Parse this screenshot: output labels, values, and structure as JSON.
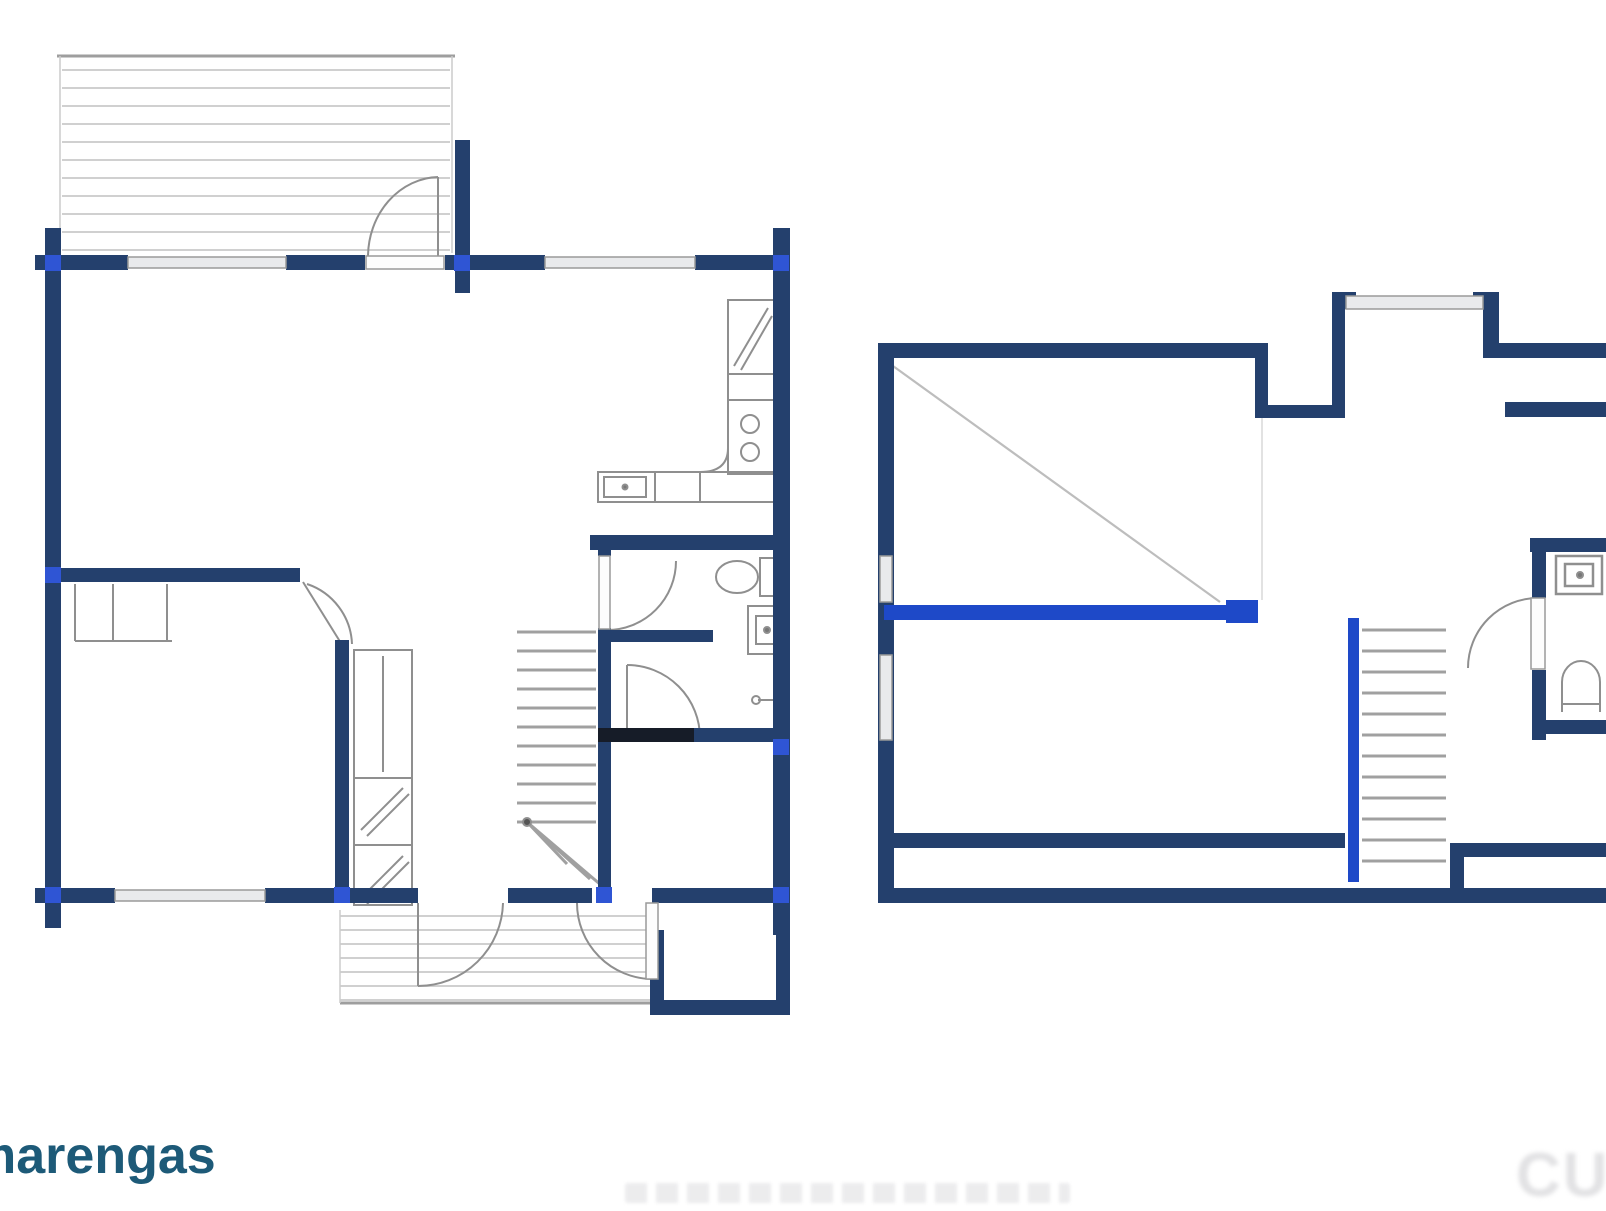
{
  "branding": {
    "logo_text": "marengas"
  },
  "watermark": {
    "bottom_right": "CUE"
  },
  "palette": {
    "wall": "#24406d",
    "wall_dark": "#161c28",
    "accent_dot": "#2f55d4",
    "bright_blue": "#1e49c8",
    "window_fill": "#e9eaec",
    "window_stroke": "#9a9a9a",
    "leaf_fill": "#fdfdfd",
    "fixture": "#8f8f8f",
    "tread": "#a0a0a0",
    "deck_line": "#d0d0d0",
    "deck_edge": "#9e9e9e",
    "slope": "#bdbdbd"
  },
  "left": {
    "deck_lines": [
      [
        62,
        70,
        450,
        70
      ],
      [
        62,
        88,
        450,
        88
      ],
      [
        62,
        106,
        450,
        106
      ],
      [
        62,
        124,
        450,
        124
      ],
      [
        62,
        142,
        450,
        142
      ],
      [
        62,
        160,
        450,
        160
      ],
      [
        62,
        178,
        450,
        178
      ],
      [
        62,
        196,
        450,
        196
      ],
      [
        62,
        214,
        450,
        214
      ],
      [
        62,
        232,
        450,
        232
      ],
      [
        62,
        250,
        450,
        250
      ],
      [
        340,
        916,
        652,
        916
      ],
      [
        340,
        930,
        652,
        930
      ],
      [
        340,
        944,
        652,
        944
      ],
      [
        340,
        958,
        652,
        958
      ],
      [
        340,
        972,
        652,
        972
      ],
      [
        340,
        986,
        652,
        986
      ],
      [
        340,
        1000,
        652,
        1000
      ]
    ],
    "deck_edges": [
      [
        57,
        56,
        455,
        56
      ],
      [
        340,
        1003,
        660,
        1003
      ]
    ],
    "deck_sides": [
      [
        60,
        56,
        60,
        253
      ],
      [
        452,
        56,
        452,
        253
      ],
      [
        340,
        910,
        340,
        1003
      ]
    ],
    "stair_treads": [
      [
        517,
        632,
        596,
        632
      ],
      [
        517,
        651,
        596,
        651
      ],
      [
        517,
        670,
        596,
        670
      ],
      [
        517,
        689,
        596,
        689
      ],
      [
        517,
        708,
        596,
        708
      ],
      [
        517,
        727,
        596,
        727
      ],
      [
        517,
        746,
        596,
        746
      ],
      [
        517,
        765,
        596,
        765
      ],
      [
        517,
        784,
        596,
        784
      ],
      [
        517,
        803,
        596,
        803
      ],
      [
        517,
        822,
        596,
        822
      ]
    ],
    "stair_fan": [
      [
        527,
        822,
        567,
        864
      ],
      [
        527,
        822,
        590,
        879
      ],
      [
        527,
        822,
        608,
        891
      ]
    ],
    "fixture_lines": [
      [
        113,
        584,
        113,
        641
      ],
      [
        167,
        584,
        167,
        641
      ],
      [
        75,
        584,
        75,
        641
      ],
      [
        75,
        641,
        172,
        641
      ],
      [
        354,
        778,
        412,
        778
      ],
      [
        354,
        845,
        412,
        845
      ],
      [
        383,
        656,
        383,
        772
      ],
      [
        361,
        830,
        403,
        788
      ],
      [
        367,
        836,
        409,
        794
      ],
      [
        361,
        898,
        403,
        856
      ],
      [
        367,
        904,
        409,
        862
      ],
      [
        734,
        366,
        768,
        308
      ],
      [
        741,
        370,
        772,
        316
      ],
      [
        655,
        472,
        655,
        502
      ],
      [
        700,
        472,
        700,
        502
      ],
      [
        728,
        400,
        774,
        400
      ],
      [
        438,
        177,
        438,
        257
      ],
      [
        418,
        903,
        418,
        986
      ],
      [
        627,
        665,
        627,
        737
      ],
      [
        303,
        582,
        344,
        648
      ],
      [
        758,
        700,
        776,
        700
      ]
    ],
    "fixture_rects": [
      [
        354,
        650,
        58,
        255
      ],
      [
        728,
        300,
        46,
        74
      ],
      [
        728,
        374,
        46,
        100
      ],
      [
        598,
        472,
        176,
        30
      ],
      [
        604,
        477,
        42,
        20
      ],
      [
        760,
        558,
        28,
        38
      ],
      [
        748,
        606,
        40,
        48
      ],
      [
        756,
        616,
        24,
        28
      ],
      [
        776,
        692,
        12,
        10
      ]
    ],
    "fixture_extras": [
      {
        "tag": "path",
        "d": "M 368 257 A 72 80 0 0 1 438 177"
      },
      {
        "tag": "path",
        "d": "M 418 986 A 85 85 0 0 0 503 903"
      },
      {
        "tag": "path",
        "d": "M 577 903 A 76 76 0 0 0 652 979"
      },
      {
        "tag": "path",
        "d": "M 307 584 A 66 66 0 0 1 352 644"
      },
      {
        "tag": "path",
        "d": "M 676 561 A 69 69 0 0 1 607 630"
      },
      {
        "tag": "path",
        "d": "M 627 665 A 73 73 0 0 1 700 738"
      },
      {
        "tag": "path",
        "d": "M 700 472 Q 728 472 728 448"
      },
      {
        "tag": "ellipse",
        "cx": 737,
        "cy": 577,
        "rx": 21,
        "ry": 16
      },
      {
        "tag": "circle",
        "cx": 750,
        "cy": 424,
        "r": 9
      },
      {
        "tag": "circle",
        "cx": 750,
        "cy": 452,
        "r": 9
      },
      {
        "tag": "circle",
        "cx": 625,
        "cy": 487,
        "r": 2.5,
        "fill": "#777777"
      },
      {
        "tag": "circle",
        "cx": 767,
        "cy": 630,
        "r": 3,
        "fill": "#777777"
      },
      {
        "tag": "circle",
        "cx": 756,
        "cy": 700,
        "r": 4
      },
      {
        "tag": "circle",
        "cx": 527,
        "cy": 822,
        "r": 4,
        "fill": "#555555"
      }
    ],
    "walls": [
      [
        35,
        255,
        93,
        15
      ],
      [
        286,
        255,
        79,
        15
      ],
      [
        445,
        255,
        100,
        15
      ],
      [
        695,
        255,
        95,
        15
      ],
      [
        45,
        228,
        16,
        700
      ],
      [
        455,
        140,
        15,
        153
      ],
      [
        773,
        228,
        17,
        512
      ],
      [
        773,
        740,
        17,
        195
      ],
      [
        650,
        930,
        14,
        85
      ],
      [
        650,
        1000,
        140,
        15
      ],
      [
        776,
        930,
        14,
        85
      ],
      [
        35,
        888,
        80,
        15
      ],
      [
        265,
        888,
        80,
        15
      ],
      [
        345,
        888,
        73,
        15
      ],
      [
        508,
        888,
        84,
        15
      ],
      [
        652,
        888,
        138,
        15
      ],
      [
        45,
        568,
        255,
        14
      ],
      [
        335,
        640,
        14,
        262
      ],
      [
        598,
        628,
        13,
        274
      ],
      [
        590,
        535,
        200,
        15
      ],
      [
        611,
        630,
        102,
        12
      ],
      [
        598,
        728,
        192,
        14
      ],
      [
        598,
        535,
        13,
        21
      ]
    ],
    "wall_dark": [
      [
        598,
        728,
        96,
        14
      ]
    ],
    "windows": [
      [
        128,
        257,
        158,
        11
      ],
      [
        545,
        257,
        150,
        11
      ],
      [
        115,
        890,
        150,
        11
      ]
    ],
    "door_leaves": [
      [
        366,
        256,
        78,
        13
      ],
      [
        599,
        556,
        11,
        73
      ],
      [
        646,
        903,
        12,
        76
      ]
    ],
    "dots": [
      [
        45,
        255,
        16,
        16
      ],
      [
        454,
        255,
        16,
        16
      ],
      [
        773,
        255,
        16,
        16
      ],
      [
        45,
        567,
        16,
        16
      ],
      [
        45,
        887,
        16,
        16
      ],
      [
        334,
        887,
        16,
        16
      ],
      [
        596,
        887,
        16,
        16
      ],
      [
        773,
        739,
        16,
        16
      ],
      [
        773,
        887,
        16,
        16
      ]
    ]
  },
  "right": {
    "slope_lines": [
      [
        893,
        366,
        1220,
        602
      ]
    ],
    "faint_lines": [
      [
        1262,
        418,
        1262,
        600
      ]
    ],
    "stair_treads": [
      [
        1362,
        630,
        1446,
        630
      ],
      [
        1362,
        651,
        1446,
        651
      ],
      [
        1362,
        672,
        1446,
        672
      ],
      [
        1362,
        693,
        1446,
        693
      ],
      [
        1362,
        714,
        1446,
        714
      ],
      [
        1362,
        735,
        1446,
        735
      ],
      [
        1362,
        756,
        1446,
        756
      ],
      [
        1362,
        777,
        1446,
        777
      ],
      [
        1362,
        798,
        1446,
        798
      ],
      [
        1362,
        819,
        1446,
        819
      ],
      [
        1362,
        840,
        1446,
        840
      ],
      [
        1362,
        861,
        1446,
        861
      ]
    ],
    "fixture_lines": [
      [
        1562,
        704,
        1600,
        704
      ]
    ],
    "fixture_rects": [
      [
        1556,
        556,
        46,
        38
      ],
      [
        1565,
        564,
        28,
        22
      ]
    ],
    "fixture_extras": [
      {
        "tag": "path",
        "d": "M 1468 668 A 70 70 0 0 1 1538 598"
      },
      {
        "tag": "path",
        "d": "M 1562 712 L 1562 682 A 19 21 0 0 1 1600 682 L 1600 712"
      },
      {
        "tag": "circle",
        "cx": 1580,
        "cy": 575,
        "r": 3,
        "fill": "#777777"
      }
    ],
    "walls": [
      [
        878,
        343,
        16,
        560
      ],
      [
        878,
        343,
        390,
        15
      ],
      [
        1255,
        358,
        13,
        60
      ],
      [
        1255,
        405,
        90,
        13
      ],
      [
        1332,
        358,
        13,
        60
      ],
      [
        1332,
        292,
        13,
        66
      ],
      [
        1483,
        292,
        16,
        66
      ],
      [
        1345,
        292,
        11,
        17
      ],
      [
        1473,
        292,
        11,
        17
      ],
      [
        1499,
        343,
        107,
        15
      ],
      [
        1505,
        402,
        101,
        15
      ],
      [
        1530,
        538,
        76,
        14
      ],
      [
        1532,
        552,
        14,
        46
      ],
      [
        1532,
        670,
        14,
        70
      ],
      [
        1540,
        720,
        66,
        14
      ],
      [
        890,
        833,
        455,
        15
      ],
      [
        1450,
        843,
        156,
        14
      ],
      [
        1450,
        843,
        14,
        60
      ],
      [
        878,
        888,
        728,
        15
      ],
      [
        878,
        598,
        16,
        56
      ]
    ],
    "bright": [
      [
        884,
        605,
        352,
        15
      ],
      [
        1226,
        600,
        32,
        23
      ],
      [
        1348,
        618,
        11,
        264
      ]
    ],
    "windows": [
      [
        880,
        556,
        12,
        46
      ],
      [
        880,
        655,
        12,
        85
      ],
      [
        1346,
        296,
        137,
        13
      ]
    ],
    "door_leaves": [
      [
        1531,
        598,
        14,
        71
      ]
    ]
  }
}
